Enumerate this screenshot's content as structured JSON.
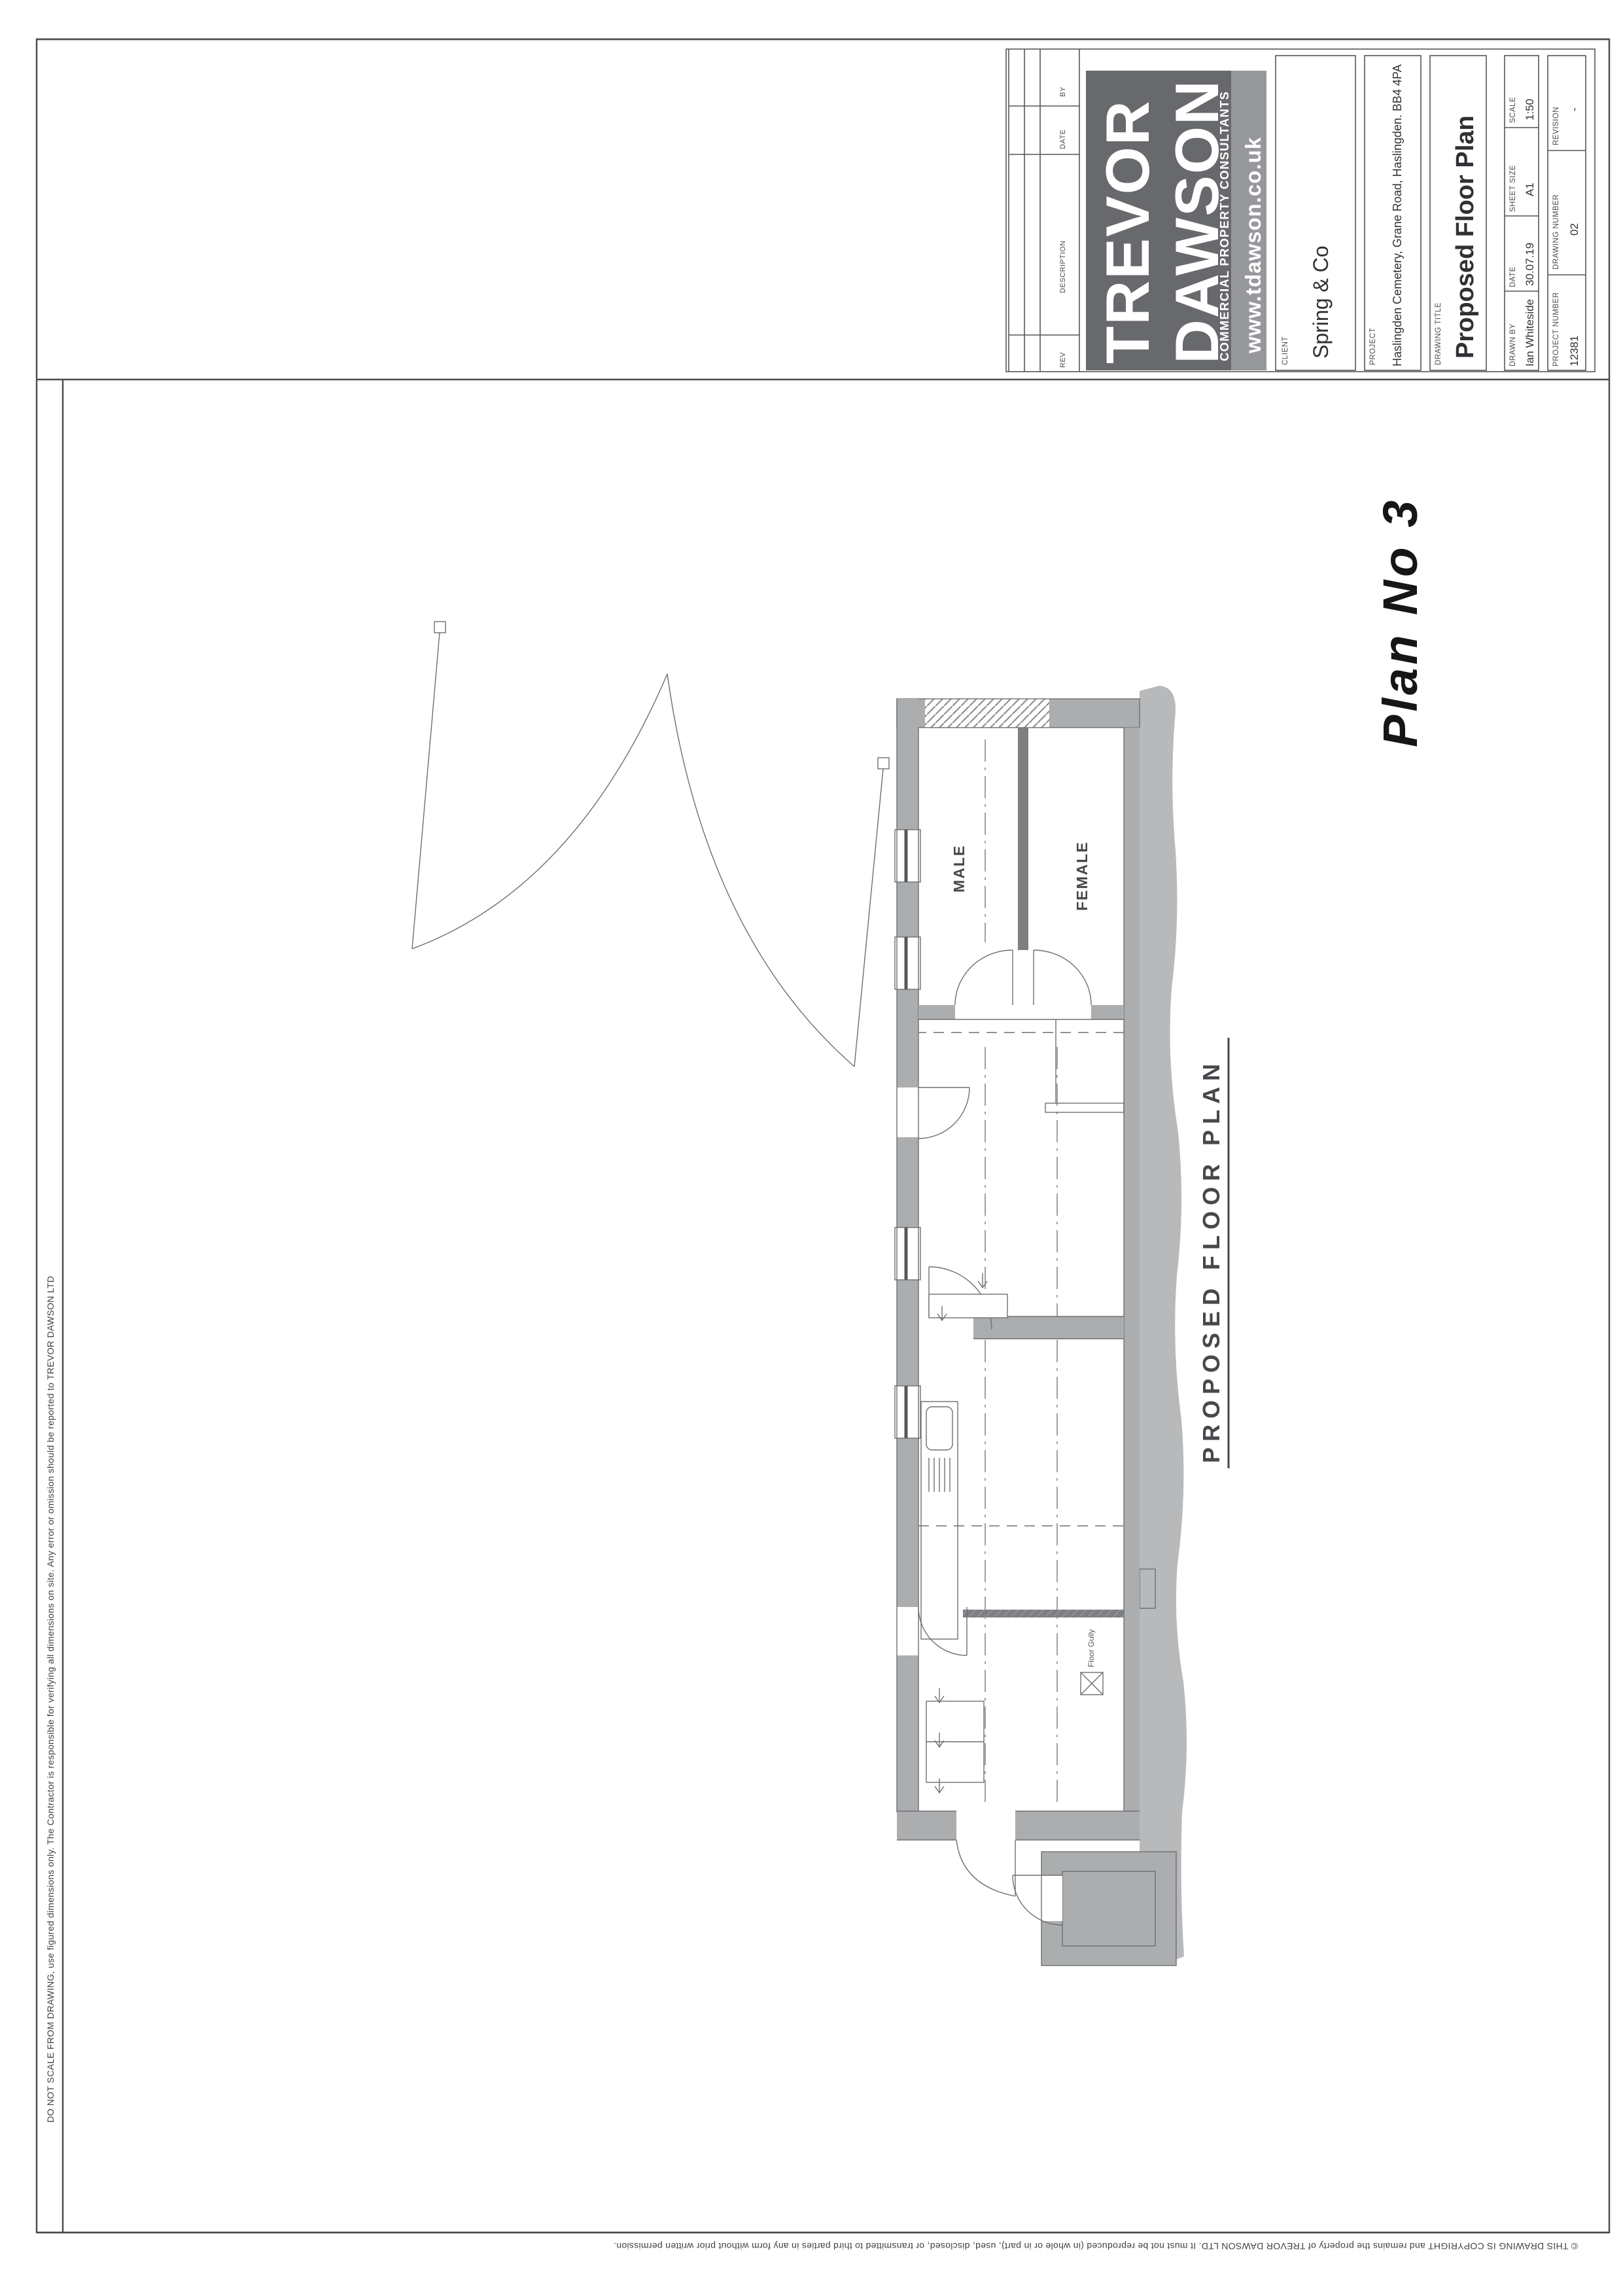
{
  "title_block": {
    "revision_table": {
      "headers": [
        "REV",
        "DESCRIPTION",
        "DATE",
        "BY"
      ]
    },
    "logo": {
      "line1": "TREVOR",
      "line2": "DAWSON",
      "tagline": "COMMERCIAL PROPERTY CONSULTANTS",
      "website": "www.tdawson.co.uk",
      "bg": "#68696c",
      "band_bg": "#97989b"
    },
    "fields": {
      "client_label": "CLIENT",
      "client": "Spring & Co",
      "project_label": "PROJECT",
      "project": "Haslingden Cemetery, Grane Road, Haslingden. BB4 4PA",
      "drawing_title_label": "DRAWING TITLE",
      "drawing_title": "Proposed Floor Plan",
      "drawn_by_label": "DRAWN BY",
      "drawn_by": "Ian Whiteside",
      "date_label": "DATE",
      "date": "30.07.19",
      "sheet_size_label": "SHEET SIZE",
      "sheet_size": "A1",
      "scale_label": "SCALE",
      "scale": "1:50",
      "project_number_label": "PROJECT NUMBER",
      "project_number": "12381",
      "drawing_number_label": "DRAWING NUMBER",
      "drawing_number": "02",
      "revision_label": "REVISION",
      "revision": "-"
    }
  },
  "plan": {
    "caption": "PROPOSED FLOOR PLAN",
    "handwritten_note": "Plan No 3",
    "room_labels": {
      "male": "MALE",
      "female": "FEMALE"
    },
    "floor_gully_label": "Floor Gully",
    "wall_color": "#abadaf",
    "rough_color": "#b7b9bb"
  },
  "notes": {
    "do_not_scale": "DO NOT SCALE FROM DRAWING, use figured dimensions only. The Contractor is responsible for verifying all dimensions on site. Any error or omission should be reported to TREVOR DAWSON LTD",
    "copyright": "© THIS DRAWING IS COPYRIGHT and remains the property of TREVOR DAWSON LTD. It must not be reproduced (in whole or in part), used, disclosed, or transmitted to third parties in any form without prior written permission."
  }
}
